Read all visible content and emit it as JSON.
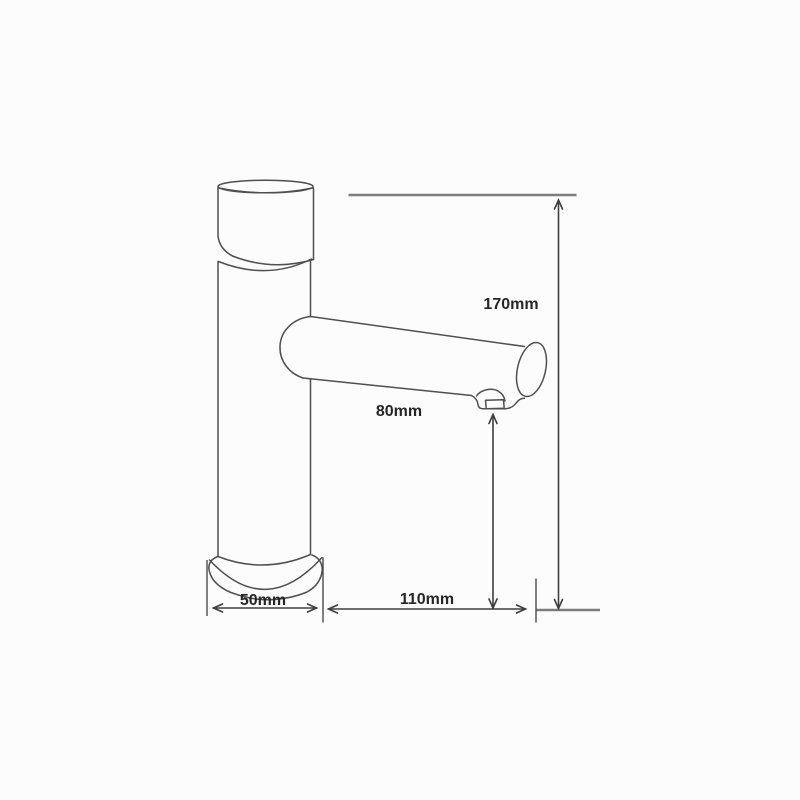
{
  "drawing": {
    "kind": "basin-faucet-technical-dimension-drawing",
    "background": "#fcfcfc",
    "outline_color": "#4f4f4f",
    "dimension_line_color": "#3e3e3e",
    "reference_line_color": "#7c7c7c",
    "label_text_color": "#262626",
    "labels": {
      "total_height": "170mm",
      "outlet_height": "80mm",
      "spout_reach": "110mm",
      "base_width": "50mm"
    }
  }
}
